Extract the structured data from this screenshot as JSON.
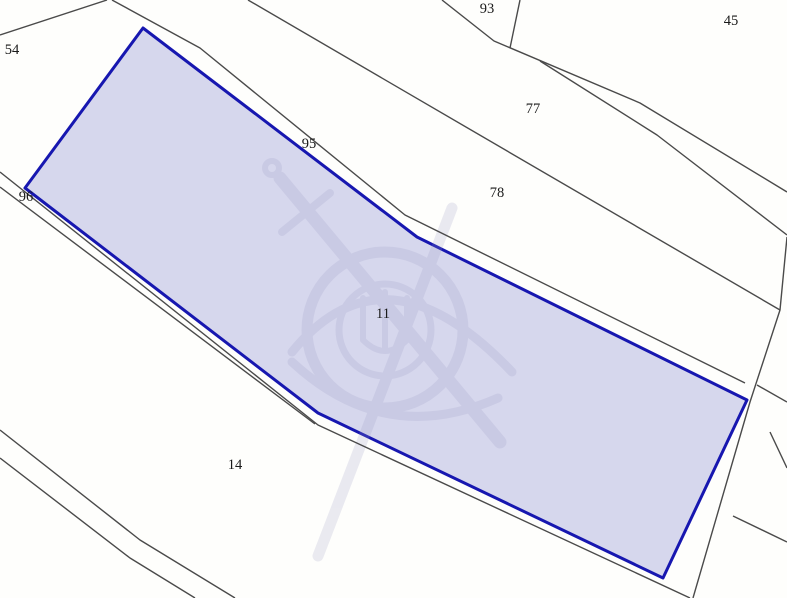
{
  "map": {
    "background_color": "#fefefc",
    "line_color": "#4a4a4a",
    "selected_parcel": {
      "label": "11",
      "fill_color": "#d6d7ed",
      "stroke_color": "#1717b0",
      "points": "143,28 417,237 747,400 663,578 318,413 25,188",
      "label_x": 383,
      "label_y": 318
    },
    "parcel_labels": [
      {
        "text": "54",
        "x": 12,
        "y": 54
      },
      {
        "text": "93",
        "x": 487,
        "y": 13
      },
      {
        "text": "45",
        "x": 731,
        "y": 25
      },
      {
        "text": "77",
        "x": 533,
        "y": 113
      },
      {
        "text": "95",
        "x": 309,
        "y": 148
      },
      {
        "text": "78",
        "x": 497,
        "y": 197
      },
      {
        "text": "96",
        "x": 26,
        "y": 201
      },
      {
        "text": "14",
        "x": 235,
        "y": 469
      }
    ],
    "boundary_lines": [
      {
        "name": "boundary-top-left",
        "points": "0,35 107,0"
      },
      {
        "name": "boundary-road-north",
        "points": "112,0 200,48 405,215 745,383"
      },
      {
        "name": "boundary-93-east",
        "points": "520,0 510,48"
      },
      {
        "name": "boundary-road-a",
        "points": "442,0 494,41 640,103 787,192"
      },
      {
        "name": "boundary-road-a2",
        "points": "540,61 657,135 787,235"
      },
      {
        "name": "boundary-77-78",
        "points": "248,0 780,310"
      },
      {
        "name": "boundary-east-steep",
        "points": "787,237 780,310 750,402 693,598"
      },
      {
        "name": "boundary-east-branch-1",
        "points": "757,385 787,402"
      },
      {
        "name": "boundary-east-short",
        "points": "770,432 787,468"
      },
      {
        "name": "boundary-east-branch-2",
        "points": "733,516 787,542"
      },
      {
        "name": "boundary-road-south",
        "points": "0,172 318,425 690,598"
      },
      {
        "name": "boundary-road-south-2",
        "points": "0,187 315,424"
      },
      {
        "name": "boundary-southwest-road-1",
        "points": "0,430 140,540 235,598"
      },
      {
        "name": "boundary-southwest-road-2",
        "points": "0,458 130,558 195,598"
      }
    ],
    "watermark": {
      "name": "cadastre-agency-emblem",
      "color": "#9a9ac2",
      "opacity": 0.2
    }
  }
}
